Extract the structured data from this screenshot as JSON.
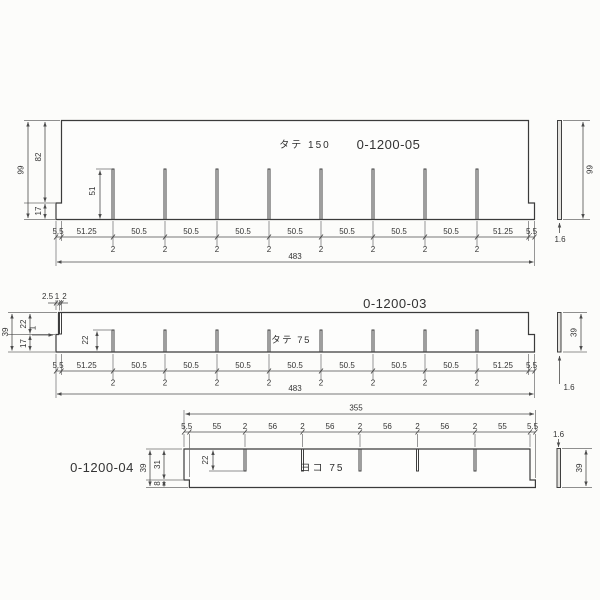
{
  "colors": {
    "line": "#3b3b3b",
    "dim_line": "#4c4c4c",
    "part_no_red": "#b8474d"
  },
  "parts": {
    "tate150": {
      "name_label": "タテ 150",
      "part_no": "0-1200-05",
      "total_height": "99",
      "upper_height": "82",
      "lower_height": "17",
      "slot_height": "51",
      "end_margin": "5.5",
      "first_pitch": "51.25",
      "pitch": "50.5",
      "slot_width": "2",
      "total_length": "483",
      "side_height": "99",
      "thickness": "1.6"
    },
    "tate75": {
      "name_label": "タテ 75",
      "part_no": "0-1200-03",
      "total_height": "39",
      "upper_height": "22",
      "lower_height": "17",
      "notch_a": "2.5",
      "notch_b": "1",
      "notch_c": "2",
      "step": "1",
      "slot_height": "22",
      "end_margin": "5.5",
      "first_pitch": "51.25",
      "pitch": "50.5",
      "slot_width": "2",
      "total_length": "483",
      "side_height": "39",
      "thickness": "1.6"
    },
    "yoko75": {
      "name_label": "ヨコ 75",
      "part_no": "0-1200-04",
      "total_height": "39",
      "upper_height": "31",
      "lower_height": "8",
      "slot_depth": "22",
      "end_margin": "5.5",
      "edge_pitch": "55",
      "pitch": "56",
      "slot_width": "2",
      "total_length": "355",
      "side_height": "39",
      "thickness": "1.6"
    }
  }
}
